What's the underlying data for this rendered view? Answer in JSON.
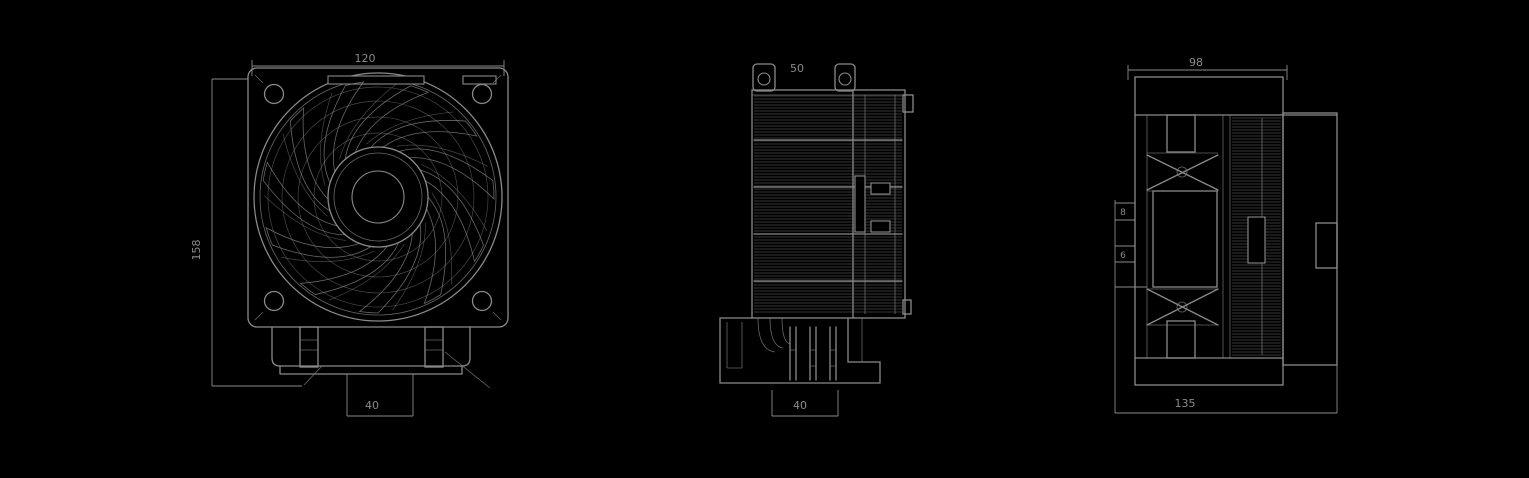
{
  "canvas": {
    "background": "#000000",
    "ink": "#8a8a8a",
    "width": 1529,
    "height": 478
  },
  "front": {
    "title": "front-view",
    "dims": {
      "top": "120",
      "left": "158",
      "bottom": "40"
    },
    "fan": {
      "cx": 378,
      "cy": 197,
      "blades": 11,
      "inner_r": 50,
      "outer_r": 116,
      "grille_arcs": 11
    }
  },
  "side": {
    "title": "side-view",
    "dims": {
      "top": "50",
      "bottom": "40"
    },
    "fins": {
      "x1": 754,
      "x2": 902,
      "y1": 96,
      "y2": 314,
      "step": 3
    }
  },
  "profile": {
    "title": "profile-view",
    "dims": {
      "top": "98",
      "left_a": "8",
      "left_b": "6",
      "bottom": "135"
    },
    "fins": {
      "x1": 1232,
      "x2": 1281,
      "y1": 118,
      "y2": 355,
      "step": 3
    }
  }
}
